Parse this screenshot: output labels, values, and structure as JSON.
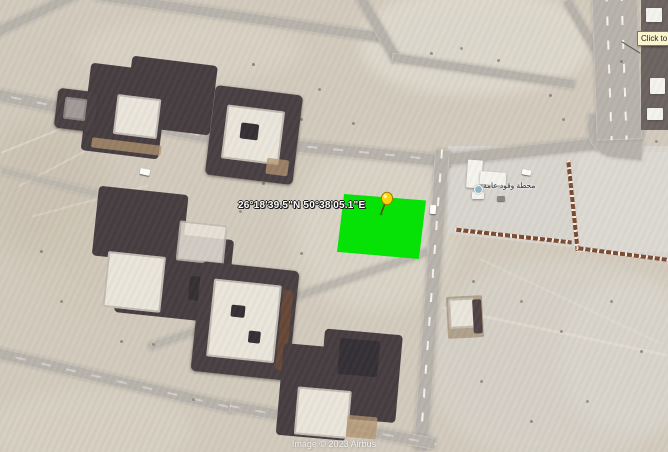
{
  "map": {
    "coordinates_label": "26°18'39.5\"N 50°38'05.1\"E",
    "poi_label": "محطة وقود عامة",
    "attribution": "Image © 2023 Airbus",
    "tooltip_text": "Click to ",
    "colors": {
      "plot_green": "#06e206",
      "pushpin_yellow": "#ffd400",
      "pushpin_outline": "#9a7d00",
      "tooltip_bg": "#fcf4ce",
      "sand": "#d2cabc",
      "road_gray": "#b7b3ab"
    }
  }
}
